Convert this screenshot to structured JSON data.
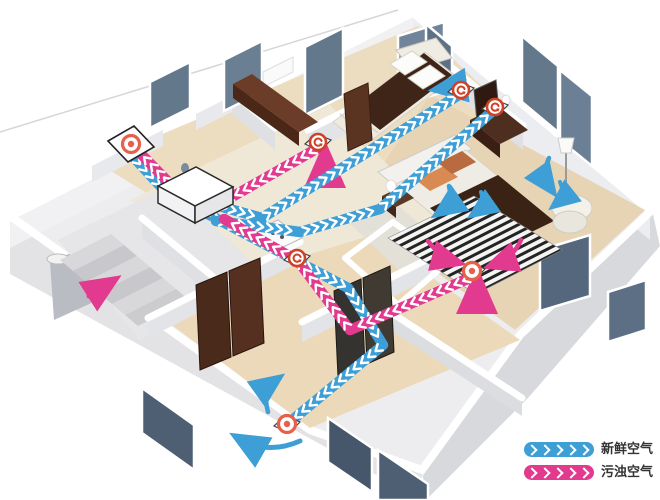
{
  "legend": {
    "chevron_count": 5,
    "items": [
      {
        "id": "fresh-air",
        "label": "新鲜空气",
        "color": "#3E9FD6"
      },
      {
        "id": "polluted-air",
        "label": "污浊空气",
        "color": "#E23A8E"
      }
    ]
  },
  "colors": {
    "fresh": "#3E9FD6",
    "exhaust": "#E23A8E",
    "chevron": "#FFFFFF",
    "vent_ring": "#E8604A",
    "vent_swirl": "#D04228"
  },
  "ventilation": {
    "unit": {
      "id": "heat-recovery-unit",
      "x": 196,
      "y": 186
    },
    "ducts": [
      {
        "id": "fresh-intake-duct",
        "color": "fresh",
        "points": [
          [
            127,
            150
          ],
          [
            176,
            203
          ]
        ]
      },
      {
        "id": "fresh-trunk-to-living",
        "color": "fresh",
        "points": [
          [
            202,
            211
          ],
          [
            348,
            288
          ],
          [
            383,
            345
          ],
          [
            291,
            421
          ]
        ]
      },
      {
        "id": "fresh-branch-to-bedroom1",
        "color": "fresh",
        "points": [
          [
            208,
            203
          ],
          [
            262,
            218
          ],
          [
            462,
            93
          ]
        ]
      },
      {
        "id": "fresh-branch-to-master",
        "color": "fresh",
        "points": [
          [
            216,
            221
          ],
          [
            300,
            232
          ],
          [
            380,
            209
          ],
          [
            495,
            109
          ]
        ]
      },
      {
        "id": "exhaust-from-bedroom1",
        "color": "exhaust",
        "points": [
          [
            318,
            148
          ],
          [
            216,
            206
          ],
          [
            184,
            198
          ],
          [
            141,
            154
          ]
        ]
      },
      {
        "id": "exhaust-from-master",
        "color": "exhaust",
        "points": [
          [
            472,
            277
          ],
          [
            350,
            330
          ],
          [
            298,
            261
          ],
          [
            224,
            219
          ]
        ]
      }
    ],
    "vents": [
      {
        "id": "outdoor-wall-terminal",
        "type": "ring",
        "base": "panel",
        "x": 131,
        "y": 144
      },
      {
        "id": "unit-top-port",
        "type": "ring",
        "base": "none",
        "x": 196,
        "y": 186
      },
      {
        "id": "bedroom1-extract-vent",
        "type": "swirl",
        "base": "diamond",
        "x": 318,
        "y": 142
      },
      {
        "id": "hallway-extract-vent",
        "type": "swirl",
        "base": "diamond",
        "x": 297,
        "y": 258
      },
      {
        "id": "bedroom1-supply-vent",
        "type": "swirl",
        "base": "diamond",
        "x": 461,
        "y": 90
      },
      {
        "id": "master-supply-vent",
        "type": "swirl",
        "base": "diamond",
        "x": 495,
        "y": 107
      },
      {
        "id": "master-extract-vent",
        "type": "ring",
        "base": "diamond",
        "x": 472,
        "y": 271
      },
      {
        "id": "living-supply-vent",
        "type": "ring",
        "base": "diamond",
        "x": 287,
        "y": 424
      }
    ],
    "arrows": [
      {
        "id": "bedroom1-extract-flow",
        "color": "exhaust",
        "d": "M325,175 L325,155",
        "w": 6
      },
      {
        "id": "master-extract-flow",
        "color": "exhaust",
        "d": "M477,299 L477,281",
        "w": 6
      },
      {
        "id": "stairs-updraft",
        "color": "exhaust",
        "d": "M89,296 L111,282",
        "w": 5
      },
      {
        "id": "bedroom1-supply-flow",
        "color": "fresh",
        "d": "M461,86 L440,89",
        "w": 5
      },
      {
        "id": "living-circulation-up",
        "color": "fresh",
        "d": "M268,412 Q262,390 276,380",
        "w": 4.5
      },
      {
        "id": "living-circulation-sweep",
        "color": "fresh",
        "d": "M300,441 Q268,455 240,439",
        "w": 5
      },
      {
        "id": "master-bed-downdraft-1",
        "color": "fresh",
        "d": "M449,186 Q453,203 440,212",
        "w": 4.5
      },
      {
        "id": "master-bed-downdraft-2",
        "color": "fresh",
        "d": "M481,192 Q485,206 475,213",
        "w": 4
      },
      {
        "id": "master-lamp-downdraft",
        "color": "fresh",
        "d": "M549,158 Q541,175 551,189",
        "w": 4.5
      },
      {
        "id": "master-chair-downdraft",
        "color": "fresh",
        "d": "M560,182 Q566,196 556,204",
        "w": 4
      },
      {
        "id": "master-rug-flow-left",
        "color": "exhaust",
        "d": "M428,241 Q441,258 456,262",
        "w": 4.5
      },
      {
        "id": "master-rug-flow-right",
        "color": "exhaust",
        "d": "M521,240 Q513,258 493,265",
        "w": 4.5
      }
    ]
  }
}
